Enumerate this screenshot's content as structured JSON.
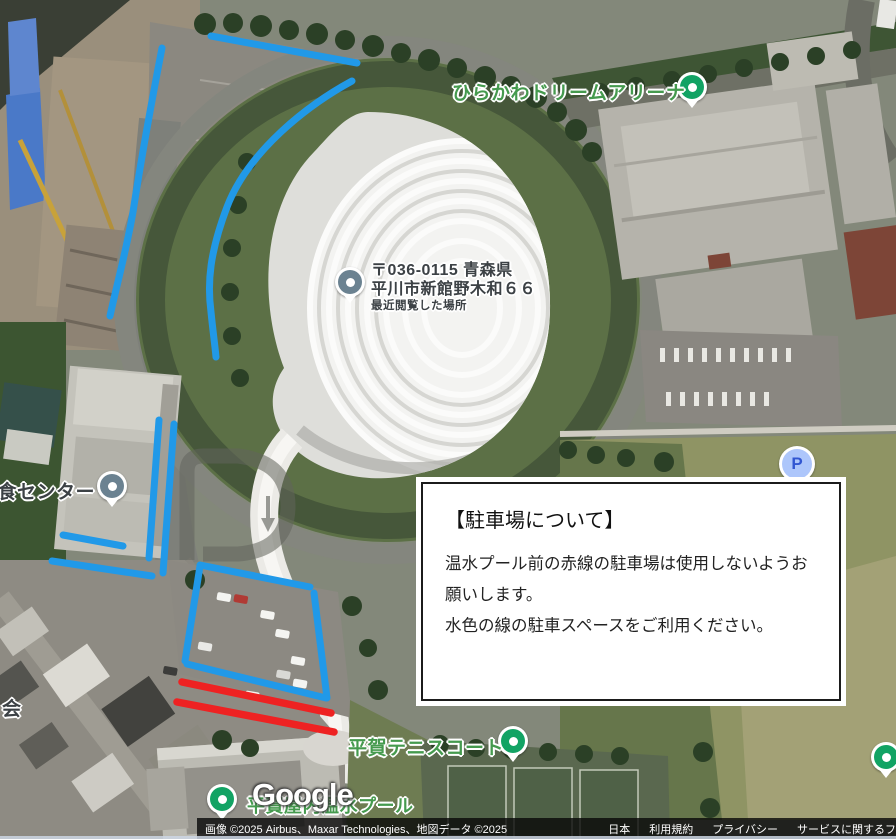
{
  "map": {
    "labels": {
      "arena": "ひらかわドリームアリーナ",
      "address_line1": "〒036-0115 青森県",
      "address_line2": "平川市新館野木和６６",
      "address_note": "最近閲覧した場所",
      "lunch_center": "給食センター",
      "partial_left": "会",
      "tennis": "平賀テニスコート",
      "pool": "平賀屋内温水プール"
    },
    "parking_icon_letter": "P",
    "watermark": "Google"
  },
  "info_box": {
    "title": "【駐車場について】",
    "body_line1": "温水プール前の赤線の駐車場は使用しないようお願いします。",
    "body_line2": "水色の線の駐車スペースをご利用ください。"
  },
  "attribution": {
    "imagery": "画像 ©2025 Airbus、Maxar Technologies、地図データ ©2025",
    "links": [
      "日本",
      "利用規約",
      "プライバシー",
      "サービスに関するフ"
    ]
  },
  "colors": {
    "annotation-blue": "#2199e8",
    "annotation-red": "#ee2222",
    "label-green": "#459a4e",
    "label-dark": "#3c4145",
    "marker-green": "#12a364",
    "marker-slate": "#6b8291",
    "picon-bg": "#adc6fb",
    "picon-letter": "#3156d2"
  }
}
